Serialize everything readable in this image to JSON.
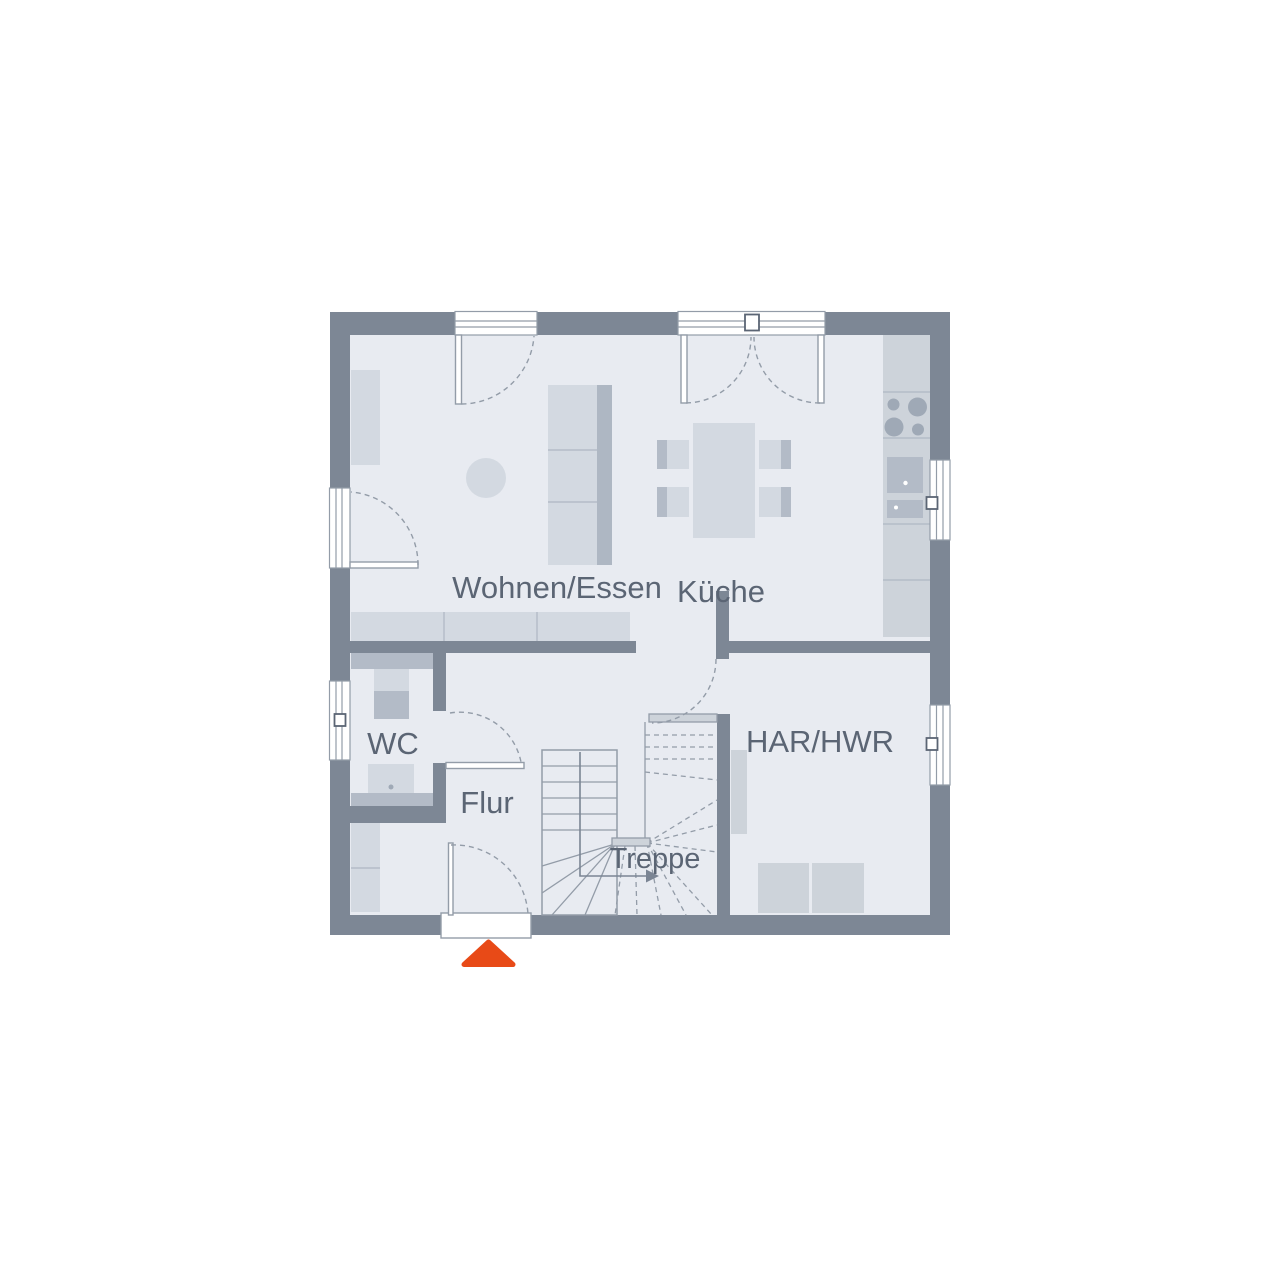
{
  "plan": {
    "type": "floor-plan",
    "rooms": [
      {
        "id": "wohnen-essen",
        "label": "Wohnen/Essen"
      },
      {
        "id": "kueche",
        "label": "Küche"
      },
      {
        "id": "wc",
        "label": "WC"
      },
      {
        "id": "flur",
        "label": "Flur"
      },
      {
        "id": "treppe",
        "label": "Treppe"
      },
      {
        "id": "har-hwr",
        "label": "HAR/HWR"
      }
    ],
    "entrance_marker": "entrance-arrow",
    "colors": {
      "wall": "#7d8795",
      "floor": "#e8ebf1",
      "furniture": "#d3d9e1",
      "furniture_shade": "#aeb7c3",
      "counter": "#cdd3da",
      "fixture": "#b3bbc7",
      "stroke": "#939ca8",
      "divline": "#b4bcc7",
      "burner": "#9fa9b6",
      "walk": "#7b8594",
      "text": "#5b6574",
      "accent": "#e84a17"
    }
  }
}
